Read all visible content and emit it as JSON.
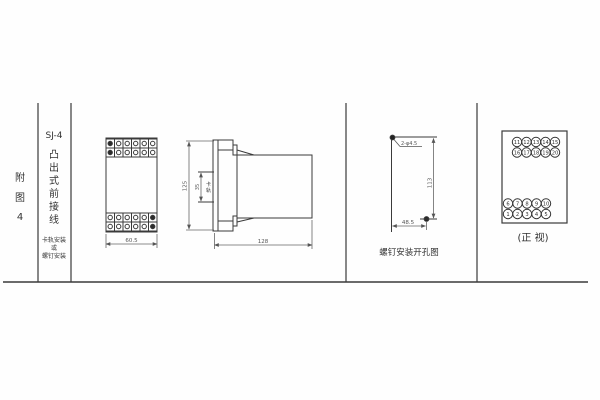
{
  "sheet": {
    "figure_label": [
      "附",
      "图",
      "4"
    ],
    "model": "SJ-4",
    "type_label": [
      "凸",
      "出",
      "式",
      "前",
      "接",
      "线"
    ],
    "mounting_note": [
      "卡轨安装",
      "或",
      "螺钉安装"
    ]
  },
  "outline_view": {
    "width_dim": "60.5"
  },
  "side_view": {
    "height_dim": "125",
    "depth_dim": "128",
    "rail_width_dim": "35",
    "rail_label": [
      "卡",
      "轨"
    ]
  },
  "drill_view": {
    "holes_label": "2-φ4.5",
    "height_dim": "113",
    "width_dim": "48.5",
    "caption": "螺钉安装开孔图"
  },
  "terminal_view": {
    "caption": "(正 视)",
    "top_row1": [
      "11",
      "12",
      "13",
      "14",
      "15"
    ],
    "top_row2": [
      "16",
      "17",
      "18",
      "19",
      "20"
    ],
    "bottom_row1": [
      "6",
      "7",
      "8",
      "9",
      "10"
    ],
    "bottom_row2": [
      "1",
      "2",
      "3",
      "4",
      "5"
    ]
  }
}
